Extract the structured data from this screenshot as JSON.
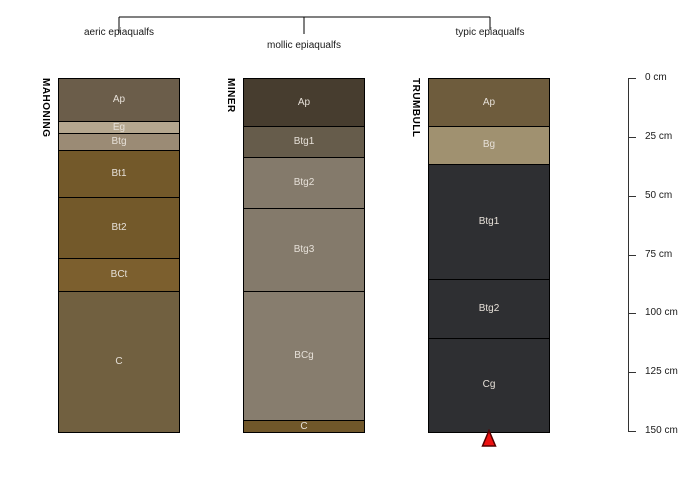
{
  "figure": {
    "classification_bracket": {
      "labels": [
        "aeric epiaqualfs",
        "mollic epiaqualfs",
        "typic epiaqualfs"
      ]
    },
    "profiles": [
      {
        "name": "MAHONING",
        "classification": "aeric epiaqualfs",
        "horizons": [
          {
            "label": "Ap",
            "color": "#6b5d4a",
            "top_cm": 0,
            "bottom_cm": 18
          },
          {
            "label": "Eg",
            "color": "#b5a78f",
            "top_cm": 18,
            "bottom_cm": 23
          },
          {
            "label": "Btg",
            "color": "#9b8b75",
            "top_cm": 23,
            "bottom_cm": 30
          },
          {
            "label": "Bt1",
            "color": "#73592a",
            "top_cm": 30,
            "bottom_cm": 50
          },
          {
            "label": "Bt2",
            "color": "#73592a",
            "top_cm": 50,
            "bottom_cm": 76
          },
          {
            "label": "BCt",
            "color": "#7c5f2e",
            "top_cm": 76,
            "bottom_cm": 90
          },
          {
            "label": "C",
            "color": "#716040",
            "top_cm": 90,
            "bottom_cm": 150
          }
        ]
      },
      {
        "name": "MINER",
        "classification": "mollic epiaqualfs",
        "horizons": [
          {
            "label": "Ap",
            "color": "#473d2f",
            "top_cm": 0,
            "bottom_cm": 20
          },
          {
            "label": "Btg1",
            "color": "#665c4b",
            "top_cm": 20,
            "bottom_cm": 33
          },
          {
            "label": "Btg2",
            "color": "#847a6b",
            "top_cm": 33,
            "bottom_cm": 55
          },
          {
            "label": "Btg3",
            "color": "#847a6b",
            "top_cm": 55,
            "bottom_cm": 90
          },
          {
            "label": "BCg",
            "color": "#877d6e",
            "top_cm": 90,
            "bottom_cm": 145
          },
          {
            "label": "C",
            "color": "#70572a",
            "top_cm": 145,
            "bottom_cm": 150
          }
        ]
      },
      {
        "name": "TRUMBULL",
        "classification": "typic epiaqualfs",
        "horizons": [
          {
            "label": "Ap",
            "color": "#6e5c3d",
            "top_cm": 0,
            "bottom_cm": 20
          },
          {
            "label": "Bg",
            "color": "#a09170",
            "top_cm": 20,
            "bottom_cm": 36
          },
          {
            "label": "Btg1",
            "color": "#2e2f32",
            "top_cm": 36,
            "bottom_cm": 85
          },
          {
            "label": "Btg2",
            "color": "#2e2f32",
            "top_cm": 85,
            "bottom_cm": 110
          },
          {
            "label": "Cg",
            "color": "#2e2f32",
            "top_cm": 110,
            "bottom_cm": 150
          }
        ]
      }
    ],
    "depth_scale": {
      "unit": "cm",
      "max_cm": 150,
      "ticks": [
        {
          "value_cm": 0,
          "label": "0 cm"
        },
        {
          "value_cm": 25,
          "label": "25 cm"
        },
        {
          "value_cm": 50,
          "label": "50 cm"
        },
        {
          "value_cm": 75,
          "label": "75 cm"
        },
        {
          "value_cm": 100,
          "label": "100 cm"
        },
        {
          "value_cm": 125,
          "label": "125 cm"
        },
        {
          "value_cm": 150,
          "label": "150 cm"
        }
      ]
    },
    "marker": {
      "shape": "triangle-up",
      "fill": "#ee1111",
      "outline": "#550000",
      "profile": "TRUMBULL"
    },
    "line_color": "#000000",
    "horizon_label_color": "#e6e0d8"
  }
}
